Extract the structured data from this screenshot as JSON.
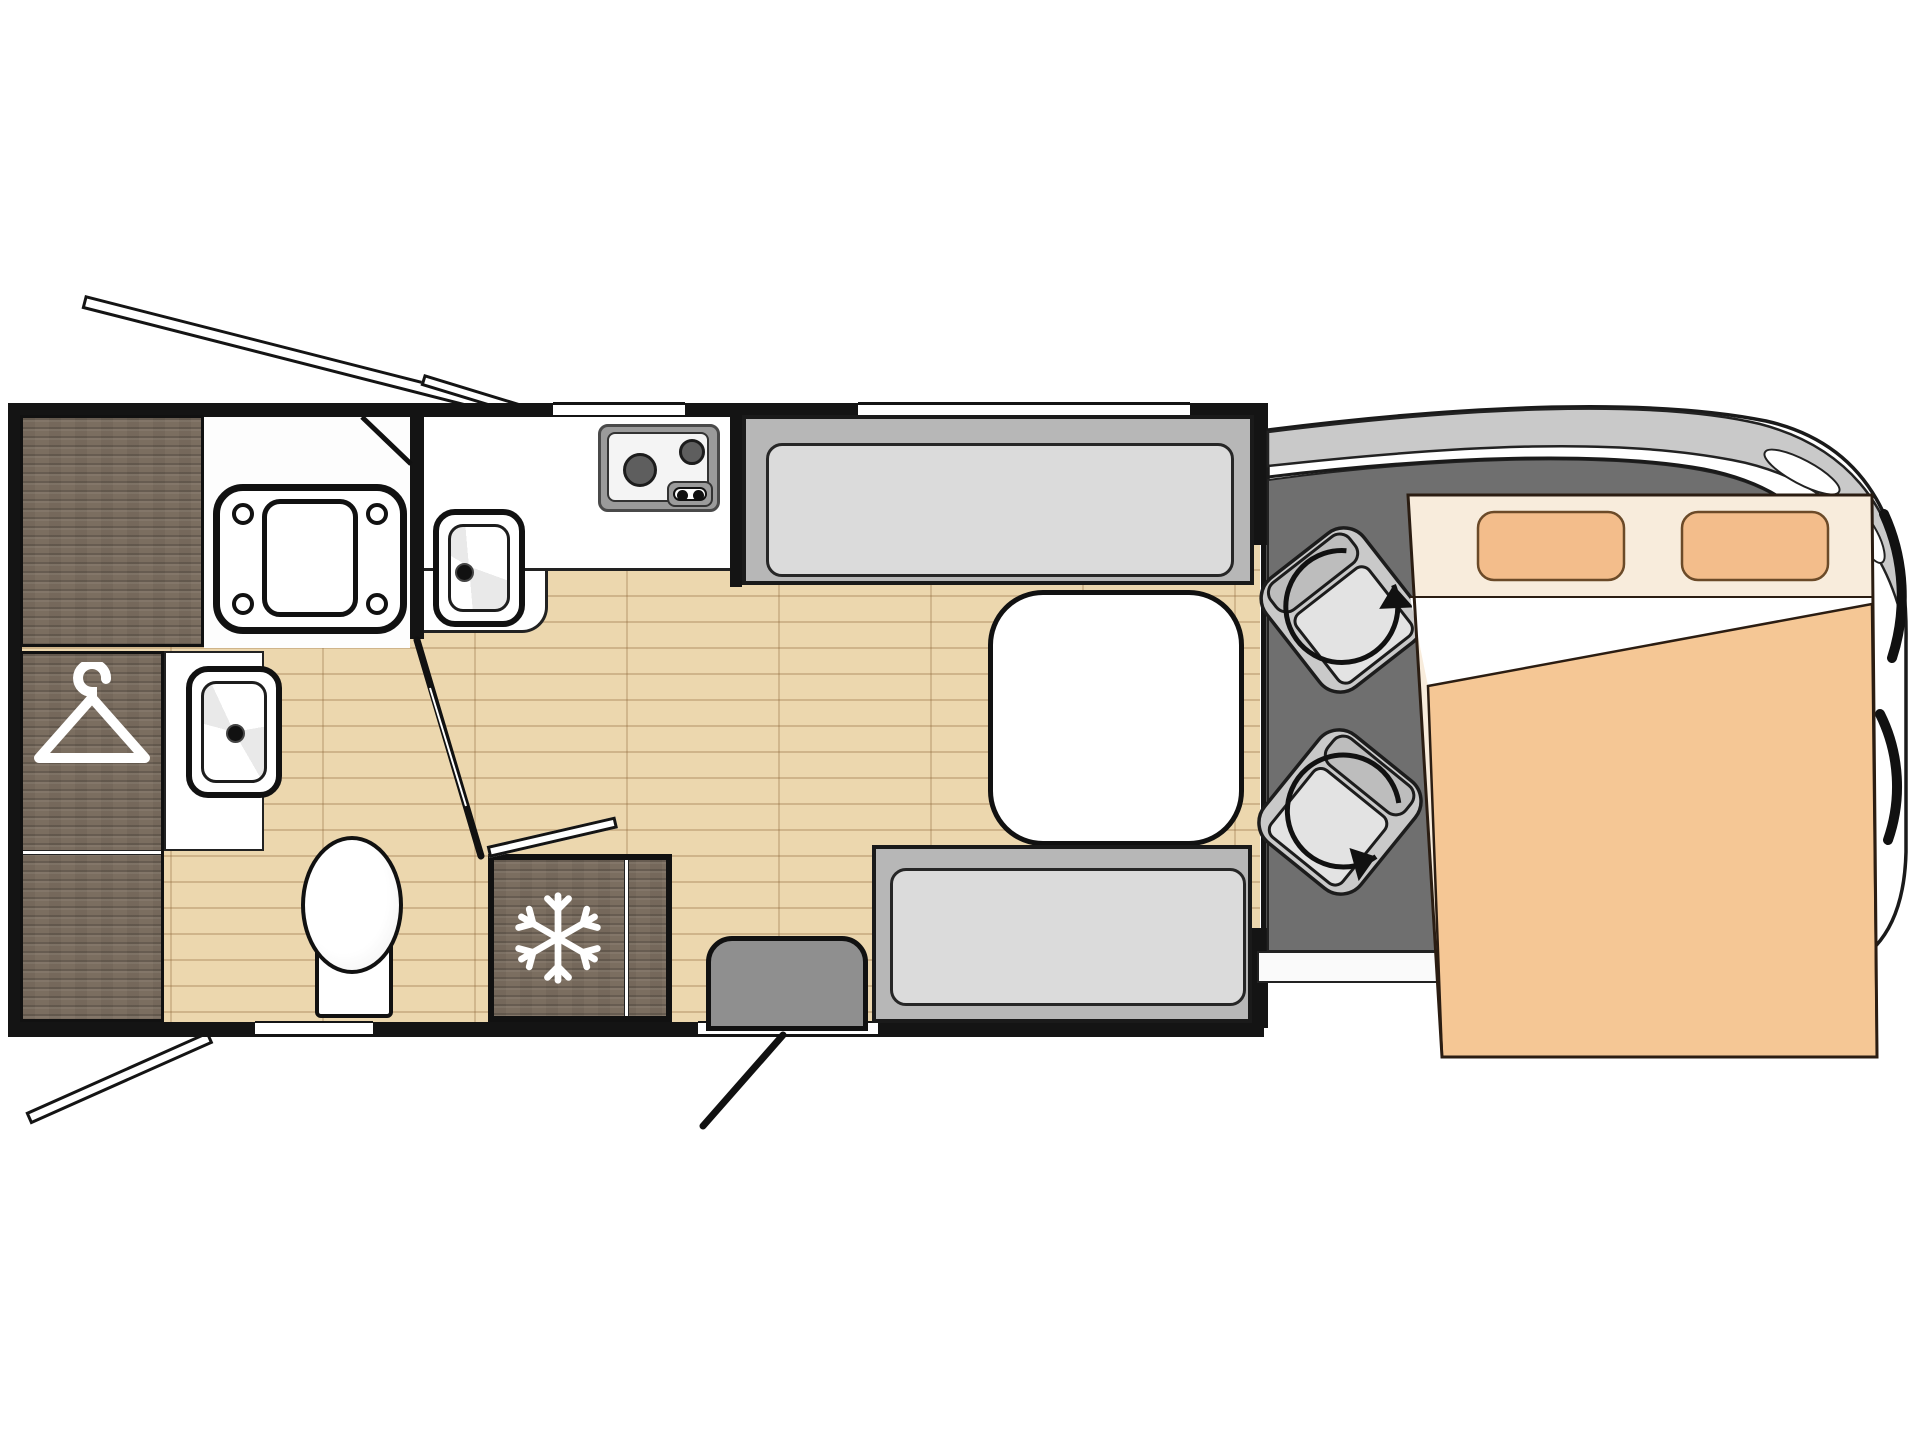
{
  "floorplan_label": "Motorhome floor plan, top view",
  "areas": {
    "wardrobe": "Wardrobe",
    "washroom_counter": "Washroom counter",
    "washbasin": "Washbasin",
    "shower_room": "Shower room",
    "shower_tray": "Shower tray",
    "toilet": "Toilet",
    "kitchen_counter": "Kitchen counter",
    "kitchen_sink": "Kitchen sink",
    "hob": "Two-burner hob",
    "fridge": "Fridge",
    "sofa_top": "Lounge sofa",
    "sofa_bottom": "Lounge sofa",
    "table": "Dinette table",
    "entrance_step": "Entrance step",
    "entry_door": "Entry door, open",
    "washroom_door": "Washroom door, open",
    "cab": "Driver cab",
    "cab_floor": "Cab floor",
    "seat_front": "Swivel cab seat",
    "seat_rear": "Swivel cab seat",
    "bed": "Drop-down double bed",
    "pillow": "Pillow",
    "awning_arm": "Awning arm",
    "window": "Window"
  },
  "icons": {
    "hanger": "hanger-icon",
    "snowflake": "snowflake-icon",
    "rotation_arrow": "rotation-arrow-icon"
  },
  "colors": {
    "wall": "#141414",
    "wood-floor": "#ecd7ae",
    "dark-wood": "#7b6e60",
    "sofa": "#b7b7b7",
    "cushion": "#dbdbdb",
    "cab-floor": "#6f6f6f",
    "body-silver": "#c9c9c9",
    "bed-blanket": "#f5c795",
    "bed-pillow": "#f3bd8b",
    "bed-sheet": "#f8ecdc",
    "step": "#8f8f8f",
    "hob-gray": "#9b9b9b",
    "burner": "#5e5e5e"
  }
}
